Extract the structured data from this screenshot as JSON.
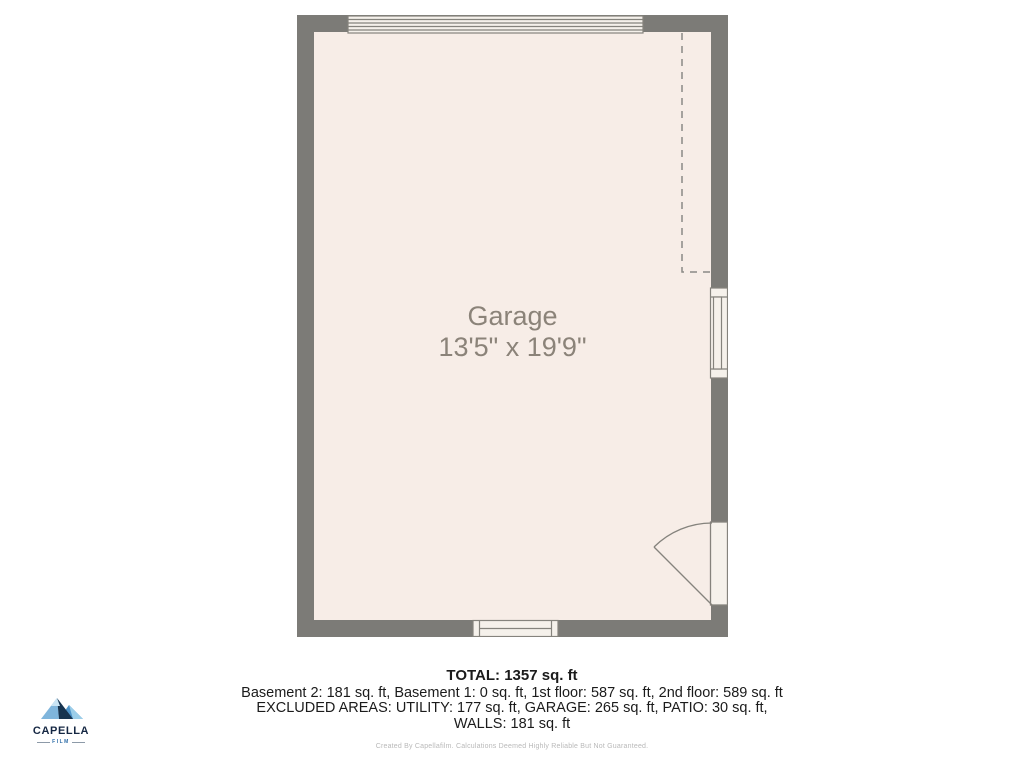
{
  "floorplan": {
    "room_label": "Garage",
    "room_dimensions": "13'5\" x 19'9\""
  },
  "summary": {
    "total": "TOTAL: 1357 sq. ft",
    "floors_line": "Basement 2: 181 sq. ft, Basement 1: 0 sq. ft, 1st floor: 587 sq. ft, 2nd floor: 589 sq. ft",
    "excluded_line": "EXCLUDED AREAS: UTILITY: 177 sq. ft, GARAGE: 265 sq. ft, PATIO: 30 sq. ft,",
    "walls_line": "WALLS: 181 sq. ft",
    "disclaimer": "Created By Capellafilm. Calculations Deemed Highly Reliable But Not Guaranteed."
  },
  "logo": {
    "brand": "CAPELLA",
    "subtitle": "FILM"
  },
  "colors": {
    "wall": "#7c7b77",
    "floor": "#f7ede7",
    "symbol_fill": "#f5f1eb",
    "symbol_stroke": "#85837d",
    "room_label_text": "#8b8379",
    "summary_text": "#1b1b1b",
    "disclaimer_text": "#b9b9b9",
    "logo_navy": "#152743",
    "logo_blue": "#2f6ea8",
    "logo_light_blue": "#7fb5dc"
  }
}
